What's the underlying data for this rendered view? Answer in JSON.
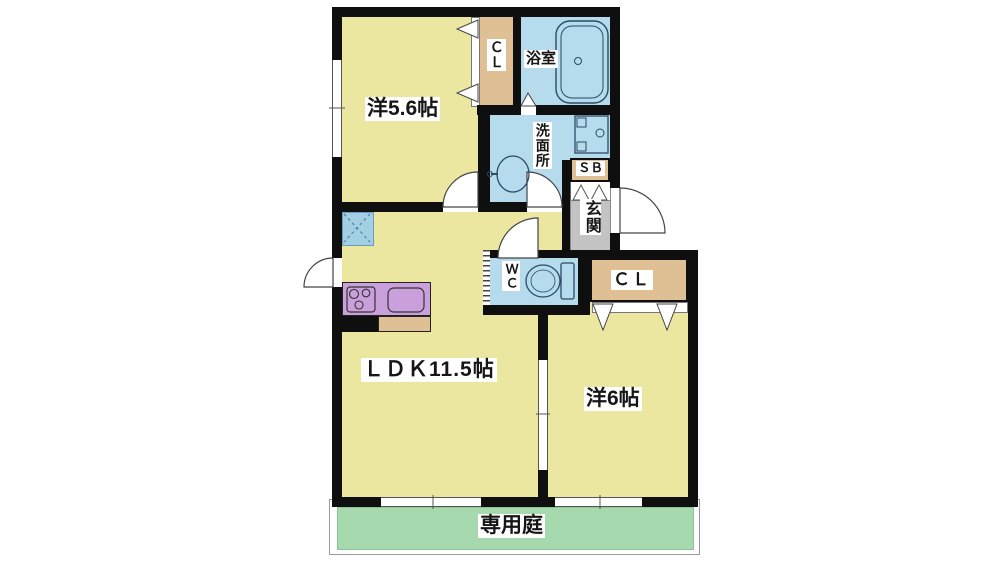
{
  "plan": {
    "rooms": {
      "western1": {
        "label": "洋5.6帖"
      },
      "ldk": {
        "label": "ＬＤＫ11.5帖"
      },
      "western2": {
        "label": "洋6帖"
      },
      "bathroom": {
        "label": "浴室"
      },
      "washroom": {
        "label": "洗面所"
      },
      "wc": {
        "label": "ＷＣ"
      },
      "entrance": {
        "label": "玄関"
      },
      "closet1": {
        "label": "ＣＬ"
      },
      "closet2": {
        "label": "ＣＬ"
      },
      "shoebox": {
        "label": "ＳＢ"
      },
      "garden": {
        "label": "専用庭"
      }
    },
    "colors": {
      "room_floor": "#ebe7a1",
      "wet_area": "#b5dbec",
      "closet": "#dfc094",
      "entrance_gray": "#c3c3c3",
      "garden_green": "#a6d9ae",
      "kitchen_counter": "#c9a0dc",
      "refrigerator_space": "#a3cfe3",
      "wall": "#0f0f0f"
    },
    "fixtures": {
      "bathtub": "bathtub-icon",
      "washing_machine_pan": "washer-pan-icon",
      "wash_basin": "sink-icon",
      "toilet": "toilet-icon",
      "stove": "stove-icon",
      "kitchen_sink": "kitchen-sink-icon",
      "refrigerator_space": "fridge-space-icon"
    }
  }
}
